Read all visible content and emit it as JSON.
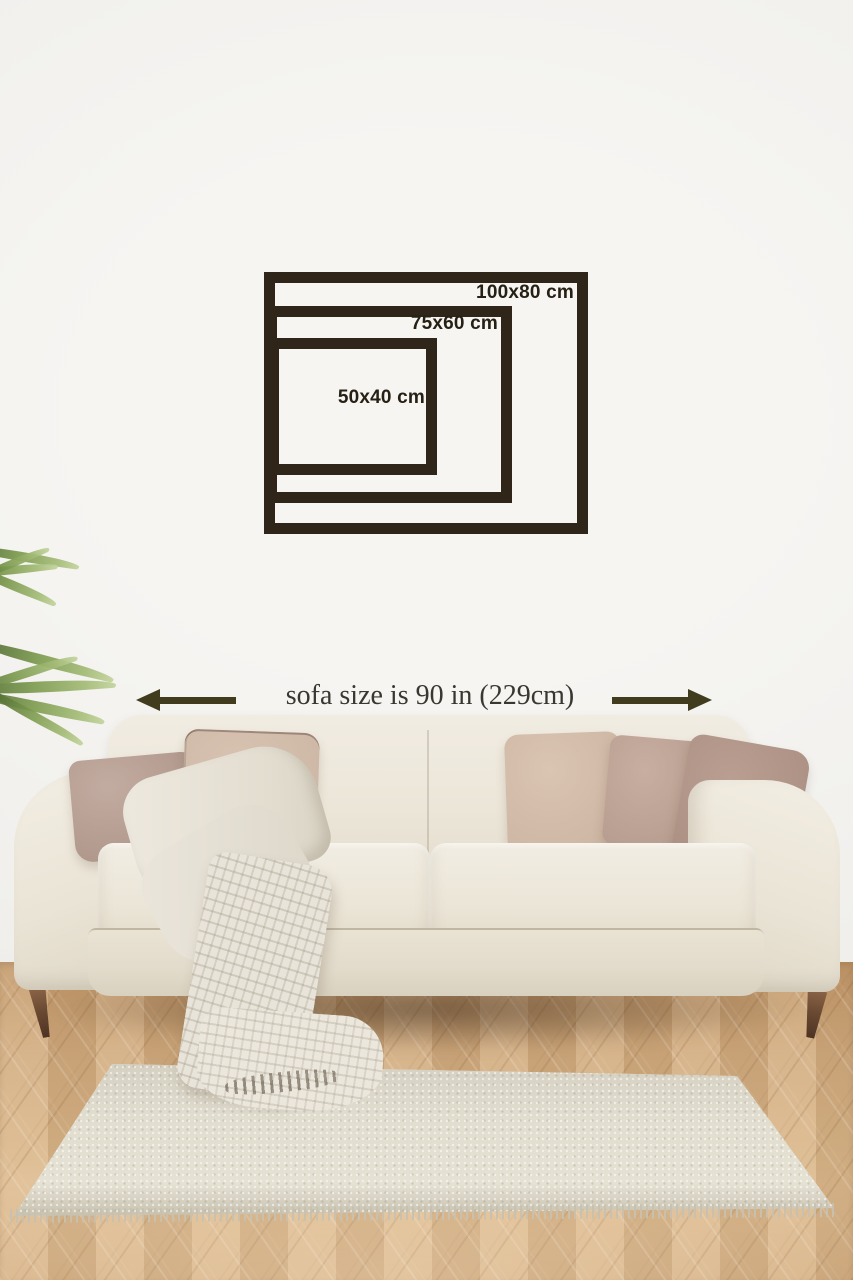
{
  "size_guide": {
    "frames": [
      {
        "name": "large",
        "label": "100x80 cm"
      },
      {
        "name": "medium",
        "label": "75x60 cm"
      },
      {
        "name": "small",
        "label": "50x40 cm"
      }
    ],
    "frame_color": "#2f2519",
    "label_color": "#262015"
  },
  "sofa_note": {
    "text": "sofa size is 90 in (229cm)",
    "arrow_color": "#403c1d",
    "text_color": "#3a3731"
  },
  "scene_colors": {
    "wall": "#f2f1ee",
    "sofa": "#ebe5d8",
    "floor": "#d0aa7e",
    "rug": "#dedacf",
    "plant": "#7c9a4e",
    "legs": "#6b4a33",
    "pillows": [
      "#b59c92",
      "#cfb9a9",
      "#d4bdac",
      "#c0a698",
      "#af9487"
    ]
  }
}
